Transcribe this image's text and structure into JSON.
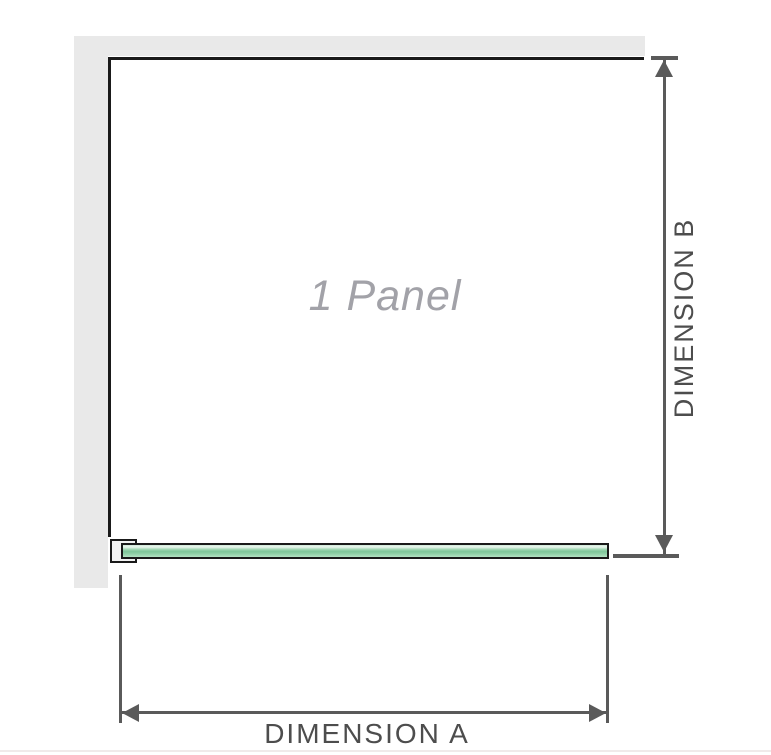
{
  "diagram": {
    "panel_label": "1 Panel",
    "dimension_a_label": "DIMENSION A",
    "dimension_b_label": "DIMENSION B"
  },
  "colors": {
    "wall": "#e9e9e9",
    "outline": "#1a1a1a",
    "dimension": "#5a5a5a",
    "label_text": "#4d4d4d",
    "panel_text": "#a2a2a8",
    "glass_light": "#cfe9d6",
    "glass_dark": "#7ec69a",
    "bracket_fill": "#f2f2f2",
    "bottom_rule": "#f0eaea"
  }
}
